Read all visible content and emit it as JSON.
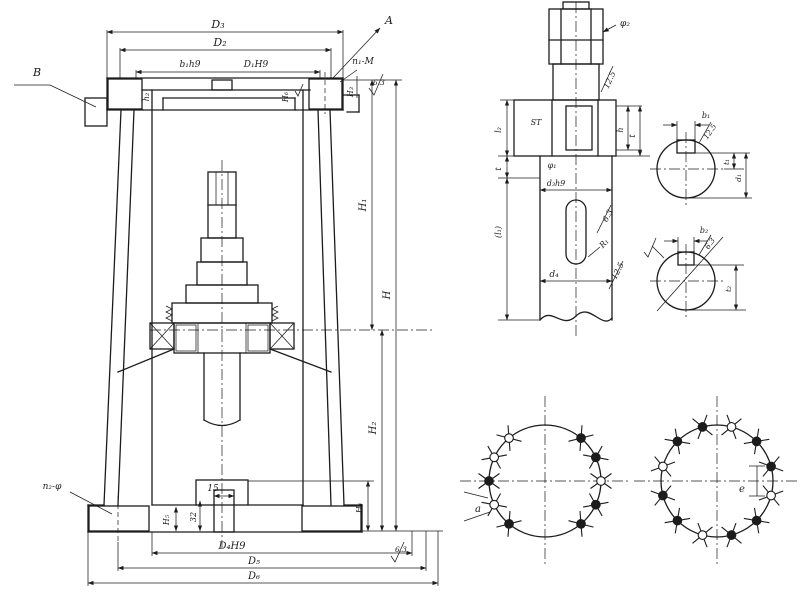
{
  "colors": {
    "ink": "#1c1c1c",
    "paper": "#ffffff"
  },
  "main_view": {
    "label_a": "A",
    "label_b": "B",
    "dim_d3": "D₃",
    "dim_d2": "D₂",
    "dim_b1h9": "b₁h9",
    "dim_d1h9": "D₁H9",
    "dim_h_small_left": "h₂",
    "dim_h6": "H₆",
    "dim_h3": "H₃",
    "bolt_note_top": "n₁-M",
    "roughness_top": "6.3",
    "dim_h1": "H₁",
    "dim_h": "H",
    "dim_h2": "H₂",
    "dim_h4": "H₄",
    "roughness_bottom": "6.3",
    "dim_15": "15",
    "dim_32": "32",
    "dim_h5": "H₅",
    "bolt_note_bottom": "n₂-φ",
    "dim_d4h9": "D₄H9",
    "dim_d5": "D₅",
    "dim_d6": "D₆"
  },
  "shaft_view": {
    "dim_phi2": "φ₂",
    "roughness_upper": "12.5",
    "mark_st": "ST",
    "dim_phi1": "φ₁",
    "dim_d3h9": "d₃h9",
    "dim_h": "h",
    "dim_t_right": "t",
    "roughness_keyway": "6.3",
    "dim_r1": "R₁",
    "dim_d4": "d₄",
    "roughness_lower": "12.5",
    "dim_l2": "l₂",
    "dim_t_left": "t",
    "dim_l1": "(l₁)"
  },
  "section_upper": {
    "dim_b1": "b₁",
    "roughness": "12.5",
    "dim_t1": "t₁",
    "dim_d1": "d₁"
  },
  "section_lower": {
    "dim_b2": "b₂",
    "roughness": "6.3",
    "dim_t2": "t₂"
  },
  "bolt_left": {
    "dim_a": "a"
  },
  "bolt_right": {
    "dim_e": "e"
  }
}
